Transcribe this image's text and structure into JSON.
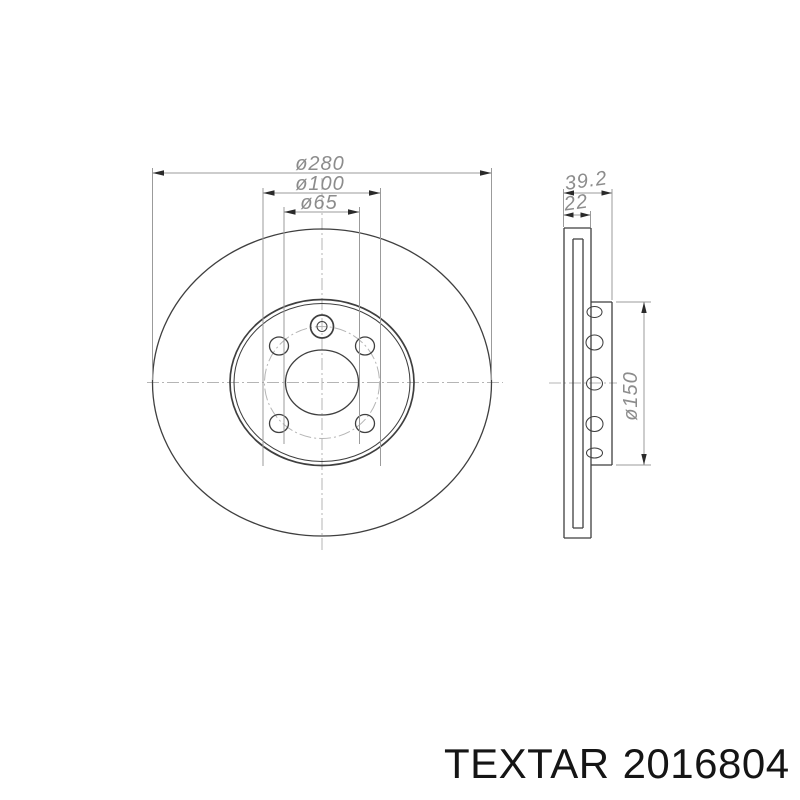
{
  "drawing": {
    "front_view": {
      "outer_diameter_label": "ø280",
      "bolt_circle_label": "ø100",
      "center_bore_label": "ø65"
    },
    "side_view": {
      "total_width_label": "39.2",
      "disc_thickness_label": "22",
      "hub_diameter_label": "ø150"
    }
  },
  "branding": {
    "brand": "TEXTAR",
    "part_number": "2016804"
  },
  "colors": {
    "line": "#3f3f3f",
    "dim_line": "#9b9b9b",
    "dim_text": "#8c8c8c",
    "centerline": "#b5b5b5",
    "arrow": "#2a2a2a",
    "brand_text": "#151515",
    "background": "#ffffff"
  }
}
